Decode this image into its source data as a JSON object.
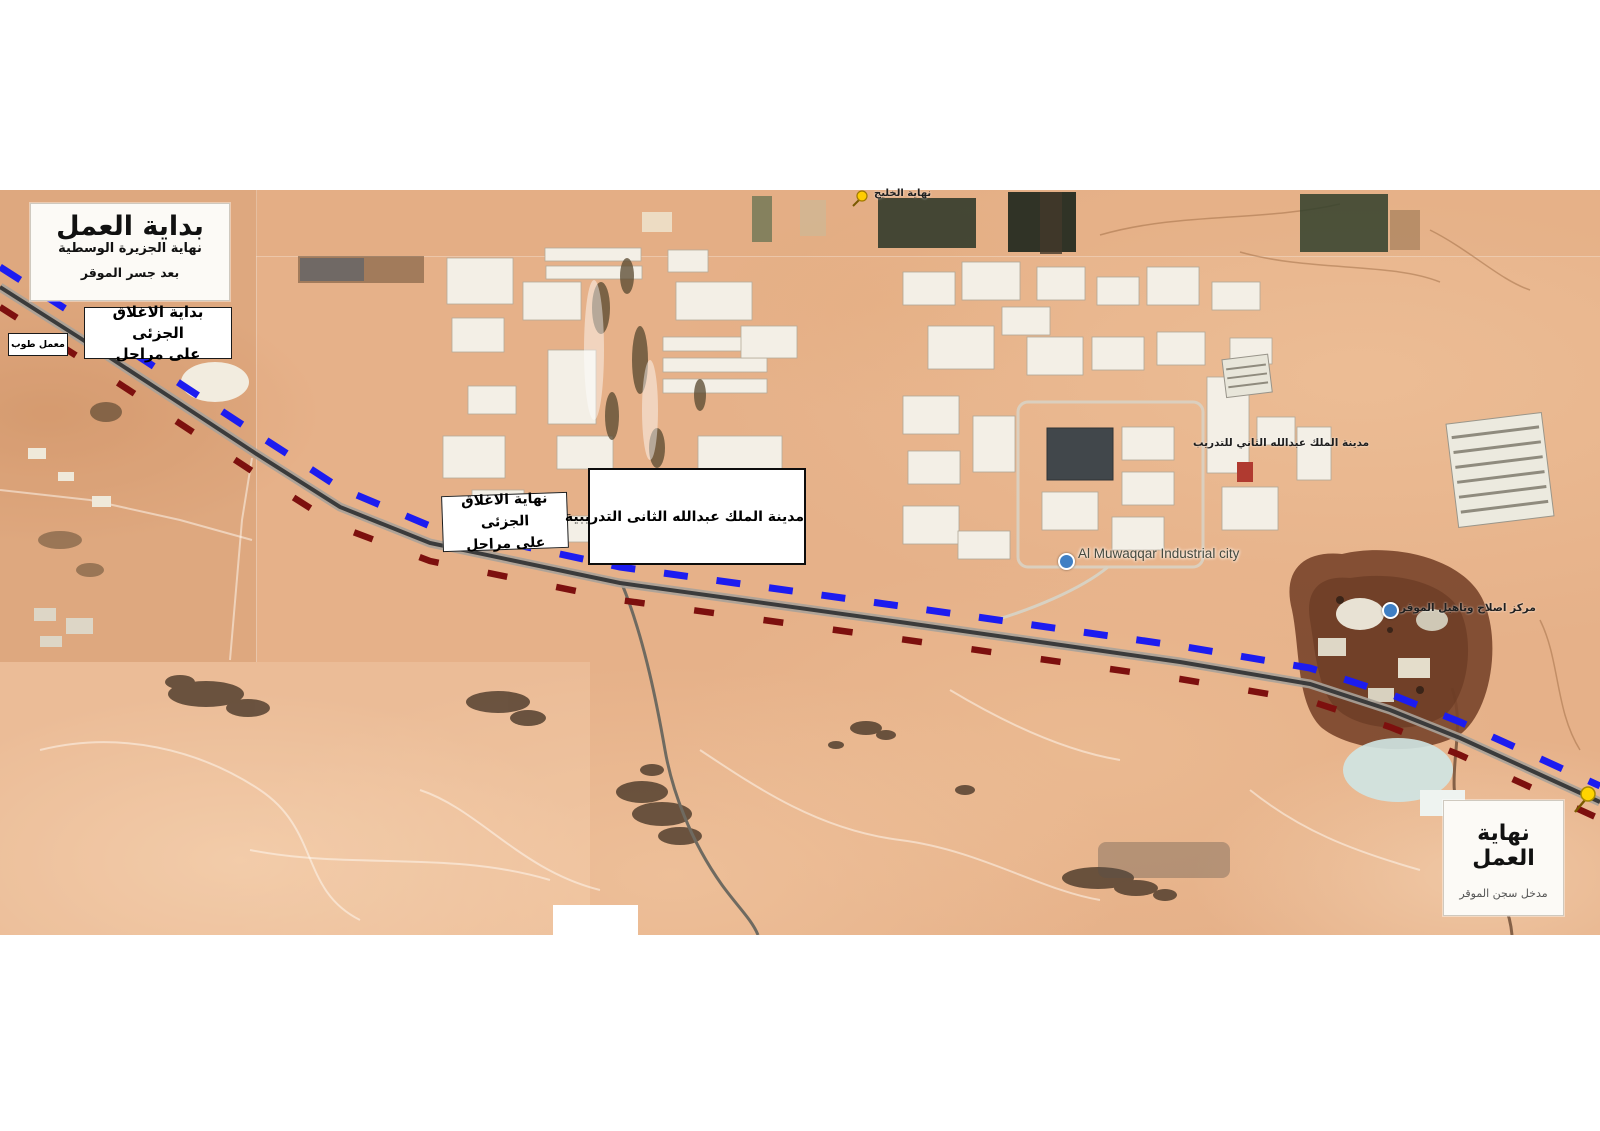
{
  "labels": {
    "start_box": {
      "title": "بداية العمل",
      "line2": "نهاية الجزيرة الوسطية",
      "line3": "بعد جسر الموقر"
    },
    "closure_start": {
      "line1": "بداية الاغلاق الجزئى",
      "line2": "على مراحل"
    },
    "brick_factory": "معمل طوب",
    "closure_end": {
      "line1": "نهاية الاغلاق الجزئى",
      "line2": "على مراحل"
    },
    "training_city_box": "مدينة الملك عبدالله الثانى التدريبية",
    "end_box": {
      "title": "نهاية العمل",
      "subtitle": "مدخل سجن الموقر"
    },
    "map_labels": {
      "gulf_end": "نهاية الخليج",
      "industrial_city": "Al Muwaqqar Industrial city",
      "training_city_map": "مدينة الملك عبدالله الثاني للتدريب",
      "prison": "مركز اصلاح وتاهيل الموقر"
    }
  },
  "legend_colors": {
    "closure_blue": "#1c1cf0",
    "closure_red": "#7d100e",
    "road_gray": "#3b3b3b",
    "pin_yellow": "#ffd400"
  }
}
